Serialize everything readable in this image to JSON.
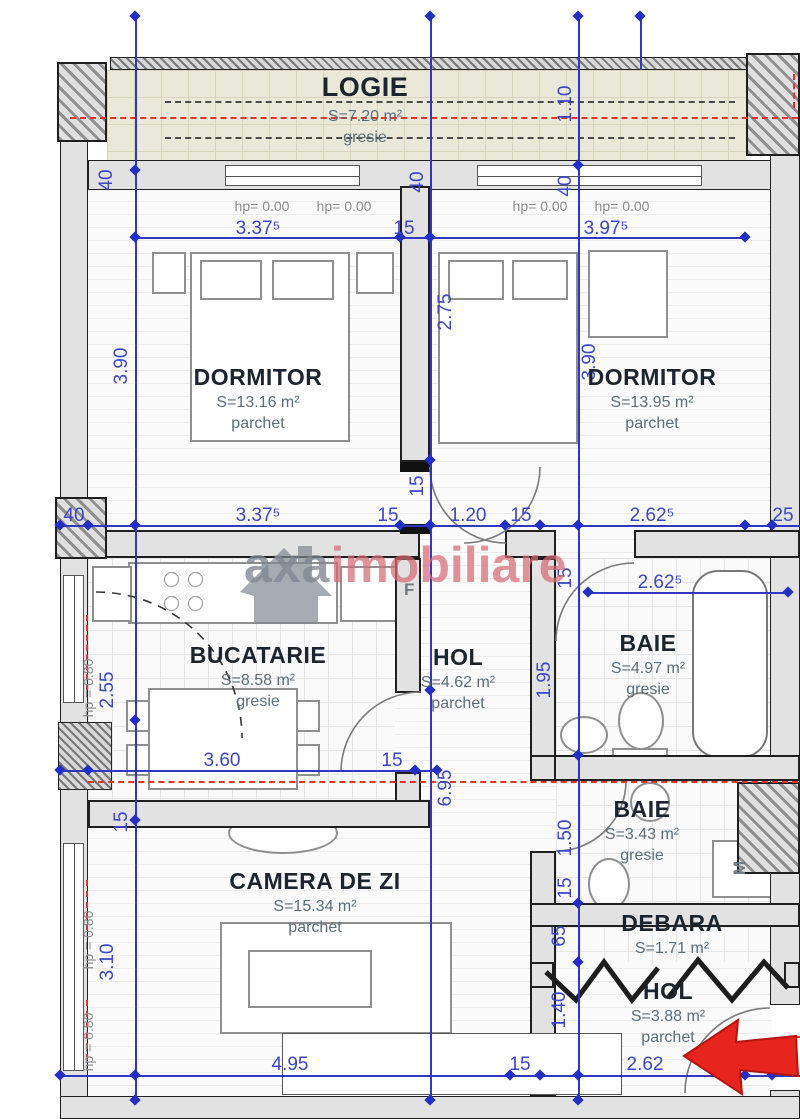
{
  "plan": {
    "rooms": [
      {
        "name": "LOGIE",
        "area": "S=7.20 m²",
        "floor": "gresie"
      },
      {
        "name": "DORMITOR",
        "area": "S=13.16 m²",
        "floor": "parchet"
      },
      {
        "name": "DORMITOR",
        "area": "S=13.95 m²",
        "floor": "parchet"
      },
      {
        "name": "BUCATARIE",
        "area": "S=8.58 m²",
        "floor": "gresie"
      },
      {
        "name": "HOL",
        "area": "S=4.62 m²",
        "floor": "parchet"
      },
      {
        "name": "BAIE",
        "area": "S=4.97 m²",
        "floor": "gresie"
      },
      {
        "name": "BAIE",
        "area": "S=3.43 m²",
        "floor": "gresie"
      },
      {
        "name": "CAMERA DE ZI",
        "area": "S=15.34 m²",
        "floor": "parchet"
      },
      {
        "name": "DEBARA",
        "area": "S=1.71 m²",
        "floor": ""
      },
      {
        "name": "HOL",
        "area": "S=3.88 m²",
        "floor": "parchet"
      }
    ],
    "dims_h": [
      "3.37⁵",
      "15",
      "3.97⁵",
      "40",
      "3.37⁵",
      "15",
      "1.20",
      "15",
      "2.62⁵",
      "25",
      "2.62⁵",
      "3.60",
      "15",
      "4.95",
      "15",
      "2.62",
      "25"
    ],
    "dims_v": [
      "1.10",
      "40",
      "40",
      "40",
      "3.90",
      "2.75",
      "3.90",
      "15",
      "15",
      "1.95",
      "2.55",
      "6.95",
      "1.50",
      "15",
      "15",
      "3.10",
      "65",
      "1.40"
    ],
    "window_top_labels": [
      "hp= 0.00",
      "hp= 0.00",
      "hp= 0.00",
      "hp= 0.00"
    ],
    "window_side_labels": [
      "hp = 0.80",
      "hp = 0.80",
      "hp = 0.80"
    ],
    "appliance_labels": {
      "fridge": "F",
      "washer": "M"
    },
    "watermark": {
      "brand": "axa",
      "suffix": "imobiliare"
    },
    "colors": {
      "dimension_blue": "#3038c0",
      "centerline_red": "#e23425",
      "arrow_red": "#e7241d",
      "wall_dark": "#1f1f1f",
      "logie_floor": "#eae8d8",
      "watermark_gray": "#7d8590",
      "watermark_red": "#d66a76"
    }
  }
}
